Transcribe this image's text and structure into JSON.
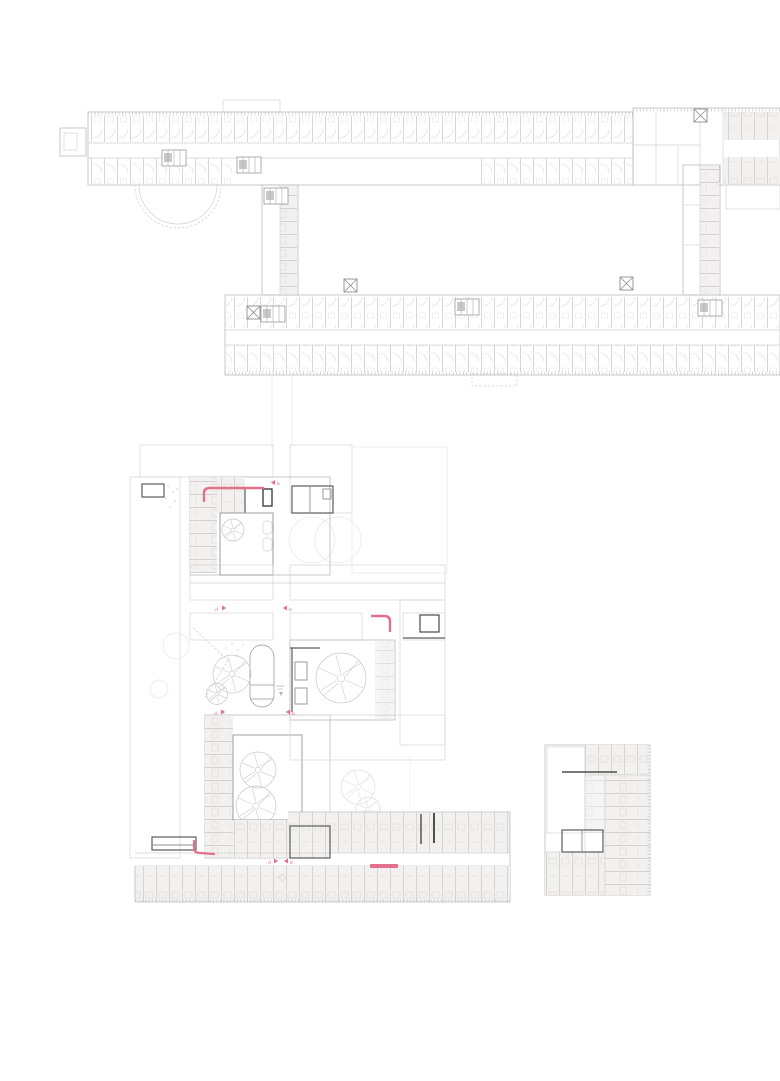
{
  "drawing": {
    "type": "architectural floor plan",
    "palette": {
      "background": "#ffffff",
      "line_faint": "#e7e7e7",
      "line_light": "#d3d3d3",
      "line_medium": "#bcbcbc",
      "line_dark": "#8f8f8f",
      "wall_black": "#555555",
      "room_fill": "#f2f1f0",
      "accent_pink": "#e4718c"
    },
    "section_markers": {
      "top": "b",
      "upper_left": "d",
      "upper_right": "b",
      "mid_left": "d",
      "mid_right": "b",
      "bottom_left": "d",
      "bottom_right": "b"
    }
  }
}
